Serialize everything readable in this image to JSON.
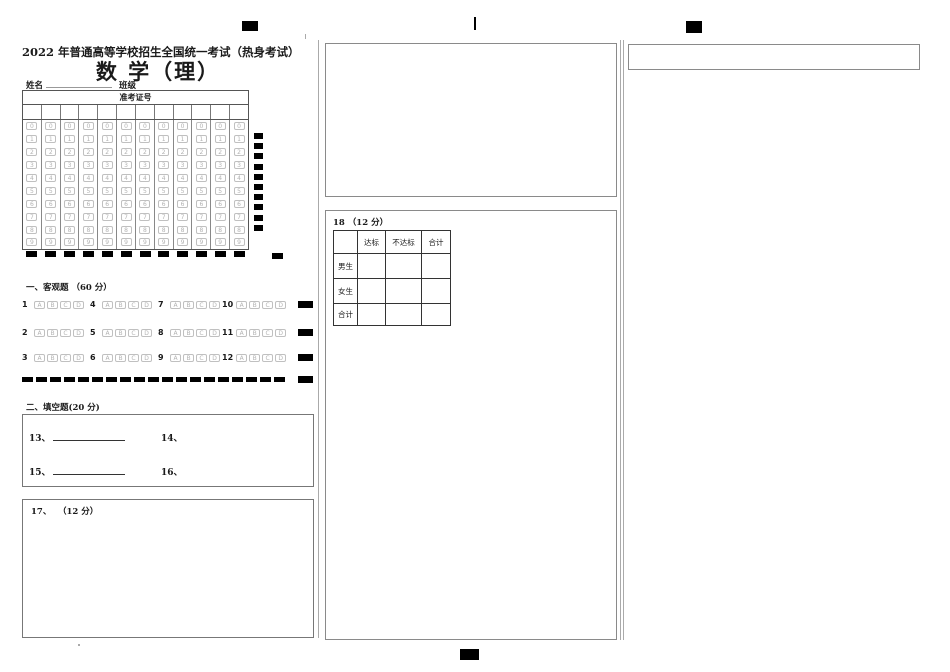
{
  "header": {
    "title_line1": "2022 年普通高等学校招生全国统一考试（热身考试）",
    "title_line2": "数 学（理）",
    "name_label": "姓名",
    "class_label": "班级"
  },
  "admission_grid": {
    "header": "准考证号",
    "columns": 12,
    "digits": [
      "0",
      "1",
      "2",
      "3",
      "4",
      "5",
      "6",
      "7",
      "8",
      "9"
    ]
  },
  "objective": {
    "heading": "一、客观题 （60 分）",
    "options": [
      "A",
      "B",
      "C",
      "D"
    ],
    "rows": [
      [
        "1",
        "4",
        "7",
        "10"
      ],
      [
        "2",
        "5",
        "8",
        "11"
      ],
      [
        "3",
        "6",
        "9",
        "12"
      ]
    ]
  },
  "fill_in": {
    "heading": "二、填空题(20 分)",
    "items": [
      {
        "label": "13、",
        "underline": true
      },
      {
        "label": "14、",
        "underline": false
      },
      {
        "label": "15、",
        "underline": true
      },
      {
        "label": "16、",
        "underline": false
      }
    ]
  },
  "q17": {
    "label": "17、",
    "score": "（12 分）"
  },
  "q18": {
    "label": "18 （12 分）",
    "table": {
      "col_headers": [
        "",
        "达标",
        "不达标",
        "合计"
      ],
      "row_headers": [
        "男生",
        "女生",
        "合计"
      ]
    }
  },
  "marks": {
    "side_count": 10,
    "bottom_count": 12,
    "dash_count": 19
  },
  "colors": {
    "ink": "#1a1a1a",
    "bubble_gray": "#b3b3b3",
    "registration_black": "#000000"
  }
}
